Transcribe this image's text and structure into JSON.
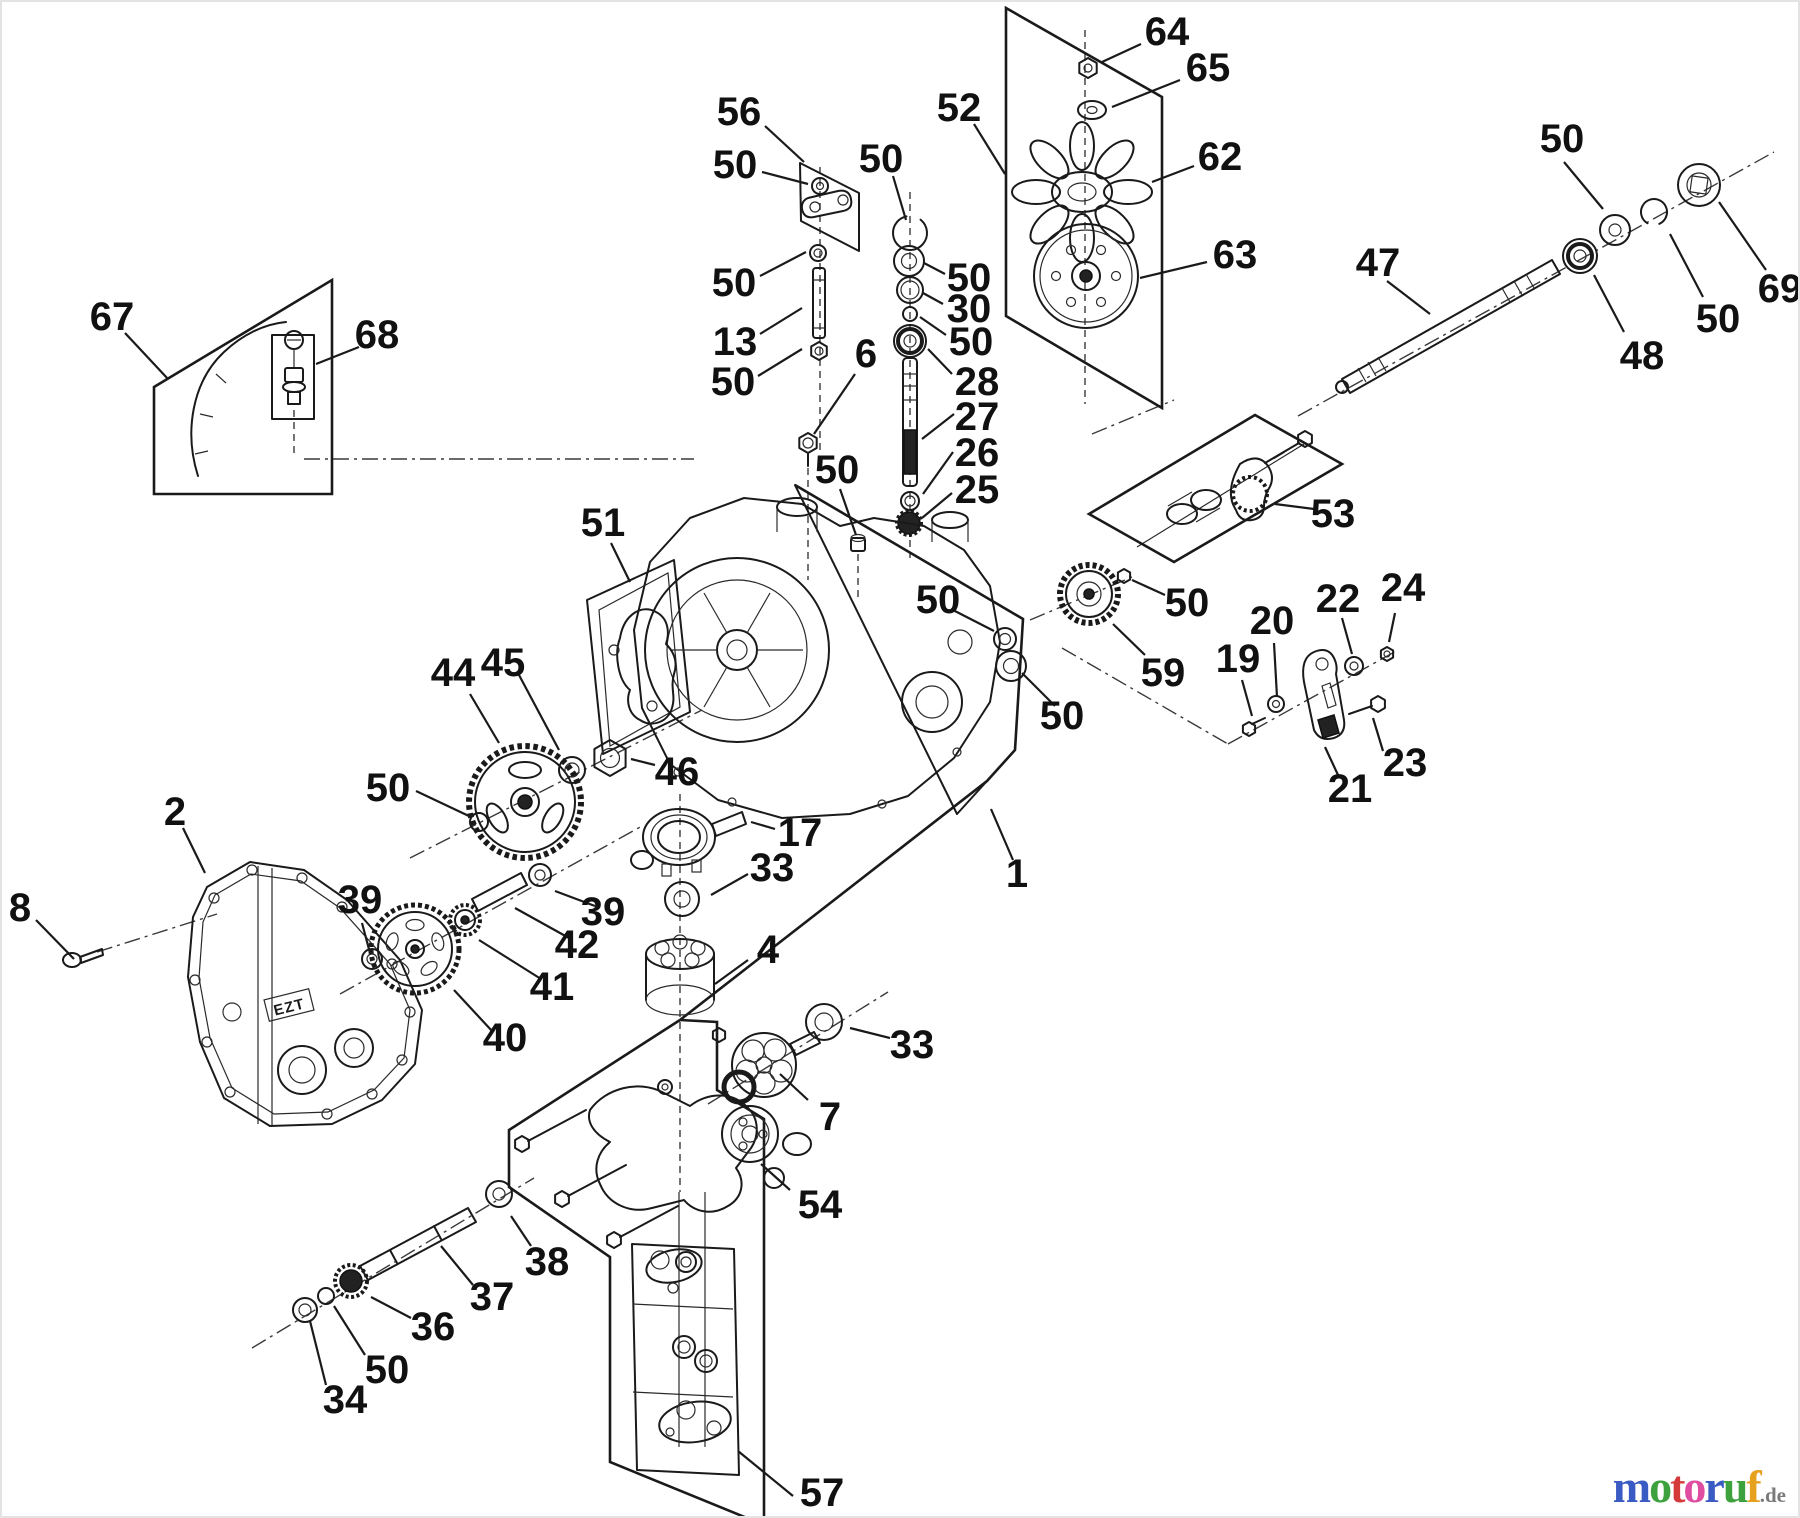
{
  "figure": {
    "type": "exploded-parts-diagram",
    "subject": "hydrostatic transaxle assembly",
    "cover_marking": "EZT",
    "ink": "#1a1a1a",
    "background": "#ffffff"
  },
  "watermark": {
    "letters": [
      {
        "char": "m",
        "color": "#3b5bc4"
      },
      {
        "char": "o",
        "color": "#3da23d"
      },
      {
        "char": "t",
        "color": "#d43a3a"
      },
      {
        "char": "o",
        "color": "#df4da0"
      },
      {
        "char": "r",
        "color": "#3b5bc4"
      },
      {
        "char": "u",
        "color": "#3da23d"
      },
      {
        "char": "f",
        "color": "#e6a11e"
      }
    ],
    "suffix": ".de",
    "suffix_color": "#7a7a7a"
  },
  "callouts": [
    {
      "label": "56",
      "x": 737,
      "y": 110,
      "leader": [
        763,
        124,
        802,
        160
      ]
    },
    {
      "label": "50",
      "x": 733,
      "y": 163,
      "leader": [
        760,
        170,
        806,
        182
      ]
    },
    {
      "label": "50",
      "x": 732,
      "y": 281,
      "leader": [
        758,
        274,
        804,
        250
      ]
    },
    {
      "label": "13",
      "x": 733,
      "y": 340,
      "leader": [
        758,
        332,
        800,
        306
      ]
    },
    {
      "label": "50",
      "x": 731,
      "y": 380,
      "leader": [
        756,
        374,
        800,
        347
      ]
    },
    {
      "label": "6",
      "x": 864,
      "y": 352,
      "leader": [
        853,
        372,
        812,
        432
      ]
    },
    {
      "label": "52",
      "x": 957,
      "y": 106,
      "leader": [
        972,
        122,
        1003,
        172
      ]
    },
    {
      "label": "64",
      "x": 1165,
      "y": 30,
      "leader": [
        1139,
        42,
        1100,
        60
      ]
    },
    {
      "label": "65",
      "x": 1206,
      "y": 66,
      "leader": [
        1178,
        78,
        1110,
        105
      ]
    },
    {
      "label": "62",
      "x": 1218,
      "y": 155,
      "leader": [
        1192,
        164,
        1150,
        180
      ]
    },
    {
      "label": "63",
      "x": 1233,
      "y": 253,
      "leader": [
        1205,
        260,
        1138,
        276
      ]
    },
    {
      "label": "50",
      "x": 879,
      "y": 157,
      "leader": [
        891,
        174,
        904,
        218
      ]
    },
    {
      "label": "50",
      "x": 967,
      "y": 276,
      "leader": [
        943,
        272,
        922,
        261
      ]
    },
    {
      "label": "30",
      "x": 967,
      "y": 307,
      "leader": [
        941,
        302,
        921,
        291
      ]
    },
    {
      "label": "50",
      "x": 969,
      "y": 340,
      "leader": [
        944,
        333,
        918,
        315
      ]
    },
    {
      "label": "28",
      "x": 975,
      "y": 380,
      "leader": [
        950,
        372,
        926,
        347
      ]
    },
    {
      "label": "27",
      "x": 975,
      "y": 415,
      "leader": [
        952,
        412,
        920,
        437
      ]
    },
    {
      "label": "26",
      "x": 975,
      "y": 451,
      "leader": [
        951,
        450,
        921,
        492
      ]
    },
    {
      "label": "25",
      "x": 975,
      "y": 488,
      "leader": [
        950,
        491,
        920,
        516
      ]
    },
    {
      "label": "50",
      "x": 1560,
      "y": 137,
      "leader": [
        1562,
        160,
        1601,
        207
      ]
    },
    {
      "label": "47",
      "x": 1376,
      "y": 261,
      "leader": [
        1385,
        279,
        1428,
        312
      ]
    },
    {
      "label": "69",
      "x": 1778,
      "y": 287,
      "leader": [
        1764,
        268,
        1717,
        200
      ]
    },
    {
      "label": "50",
      "x": 1716,
      "y": 317,
      "leader": [
        1701,
        295,
        1668,
        232
      ]
    },
    {
      "label": "48",
      "x": 1640,
      "y": 354,
      "leader": [
        1622,
        330,
        1592,
        273
      ]
    },
    {
      "label": "53",
      "x": 1331,
      "y": 512,
      "leader": [
        1312,
        507,
        1273,
        502
      ]
    },
    {
      "label": "50",
      "x": 1185,
      "y": 601,
      "leader": [
        1163,
        593,
        1130,
        578
      ]
    },
    {
      "label": "59",
      "x": 1161,
      "y": 671,
      "leader": [
        1143,
        653,
        1111,
        622
      ]
    },
    {
      "label": "19",
      "x": 1236,
      "y": 657,
      "leader": [
        1240,
        678,
        1250,
        714
      ]
    },
    {
      "label": "20",
      "x": 1270,
      "y": 619,
      "leader": [
        1272,
        641,
        1275,
        695
      ]
    },
    {
      "label": "22",
      "x": 1336,
      "y": 597,
      "leader": [
        1340,
        616,
        1350,
        652
      ]
    },
    {
      "label": "24",
      "x": 1401,
      "y": 586,
      "leader": [
        1393,
        611,
        1387,
        640
      ]
    },
    {
      "label": "21",
      "x": 1348,
      "y": 787,
      "leader": [
        1336,
        773,
        1323,
        745
      ]
    },
    {
      "label": "23",
      "x": 1403,
      "y": 761,
      "leader": [
        1381,
        749,
        1371,
        716
      ]
    },
    {
      "label": "50",
      "x": 835,
      "y": 468,
      "leader": [
        838,
        487,
        854,
        533
      ]
    },
    {
      "label": "51",
      "x": 601,
      "y": 521,
      "leader": [
        609,
        541,
        628,
        580
      ]
    },
    {
      "label": "50",
      "x": 936,
      "y": 598,
      "leader": [
        949,
        607,
        992,
        629
      ]
    },
    {
      "label": "50",
      "x": 1060,
      "y": 714,
      "leader": [
        1053,
        704,
        1020,
        671
      ]
    },
    {
      "label": "1",
      "x": 1015,
      "y": 872,
      "leader": [
        1011,
        858,
        989,
        807
      ]
    },
    {
      "label": "44",
      "x": 451,
      "y": 671,
      "leader": [
        468,
        692,
        497,
        741
      ]
    },
    {
      "label": "45",
      "x": 501,
      "y": 661,
      "leader": [
        517,
        673,
        557,
        748
      ]
    },
    {
      "label": "50",
      "x": 386,
      "y": 786,
      "leader": [
        414,
        789,
        469,
        815
      ]
    },
    {
      "label": "46",
      "x": 675,
      "y": 770,
      "leader": [
        653,
        763,
        629,
        757
      ]
    },
    {
      "label": "17",
      "x": 798,
      "y": 831,
      "leader": [
        773,
        827,
        749,
        820
      ]
    },
    {
      "label": "33",
      "x": 770,
      "y": 866,
      "leader": [
        746,
        872,
        709,
        893
      ]
    },
    {
      "label": "4",
      "x": 766,
      "y": 948,
      "leader": [
        746,
        958,
        713,
        982
      ]
    },
    {
      "label": "33",
      "x": 910,
      "y": 1043,
      "leader": [
        888,
        1036,
        848,
        1026
      ]
    },
    {
      "label": "7",
      "x": 828,
      "y": 1115,
      "leader": [
        806,
        1098,
        778,
        1072
      ]
    },
    {
      "label": "54",
      "x": 818,
      "y": 1203,
      "leader": [
        788,
        1188,
        759,
        1162
      ]
    },
    {
      "label": "67",
      "x": 110,
      "y": 315,
      "leader": [
        123,
        331,
        166,
        377
      ]
    },
    {
      "label": "68",
      "x": 375,
      "y": 333,
      "leader": [
        357,
        345,
        314,
        362
      ]
    },
    {
      "label": "2",
      "x": 173,
      "y": 810,
      "leader": [
        181,
        826,
        203,
        871
      ]
    },
    {
      "label": "8",
      "x": 18,
      "y": 906,
      "leader": [
        34,
        918,
        72,
        957
      ]
    },
    {
      "label": "39",
      "x": 358,
      "y": 898,
      "leader": [
        360,
        921,
        368,
        951
      ]
    },
    {
      "label": "40",
      "x": 503,
      "y": 1036,
      "leader": [
        490,
        1029,
        452,
        988
      ]
    },
    {
      "label": "41",
      "x": 550,
      "y": 985,
      "leader": [
        539,
        977,
        477,
        938
      ]
    },
    {
      "label": "42",
      "x": 575,
      "y": 943,
      "leader": [
        567,
        936,
        513,
        906
      ]
    },
    {
      "label": "39",
      "x": 601,
      "y": 910,
      "leader": [
        593,
        904,
        553,
        889
      ]
    },
    {
      "label": "34",
      "x": 343,
      "y": 1398,
      "leader": [
        324,
        1383,
        308,
        1319
      ]
    },
    {
      "label": "50",
      "x": 385,
      "y": 1368,
      "leader": [
        363,
        1353,
        332,
        1304
      ]
    },
    {
      "label": "36",
      "x": 431,
      "y": 1325,
      "leader": [
        409,
        1316,
        369,
        1295
      ]
    },
    {
      "label": "37",
      "x": 490,
      "y": 1295,
      "leader": [
        471,
        1283,
        439,
        1244
      ]
    },
    {
      "label": "38",
      "x": 545,
      "y": 1260,
      "leader": [
        529,
        1244,
        509,
        1214
      ]
    },
    {
      "label": "57",
      "x": 820,
      "y": 1491,
      "leader": [
        791,
        1494,
        736,
        1449
      ]
    }
  ]
}
